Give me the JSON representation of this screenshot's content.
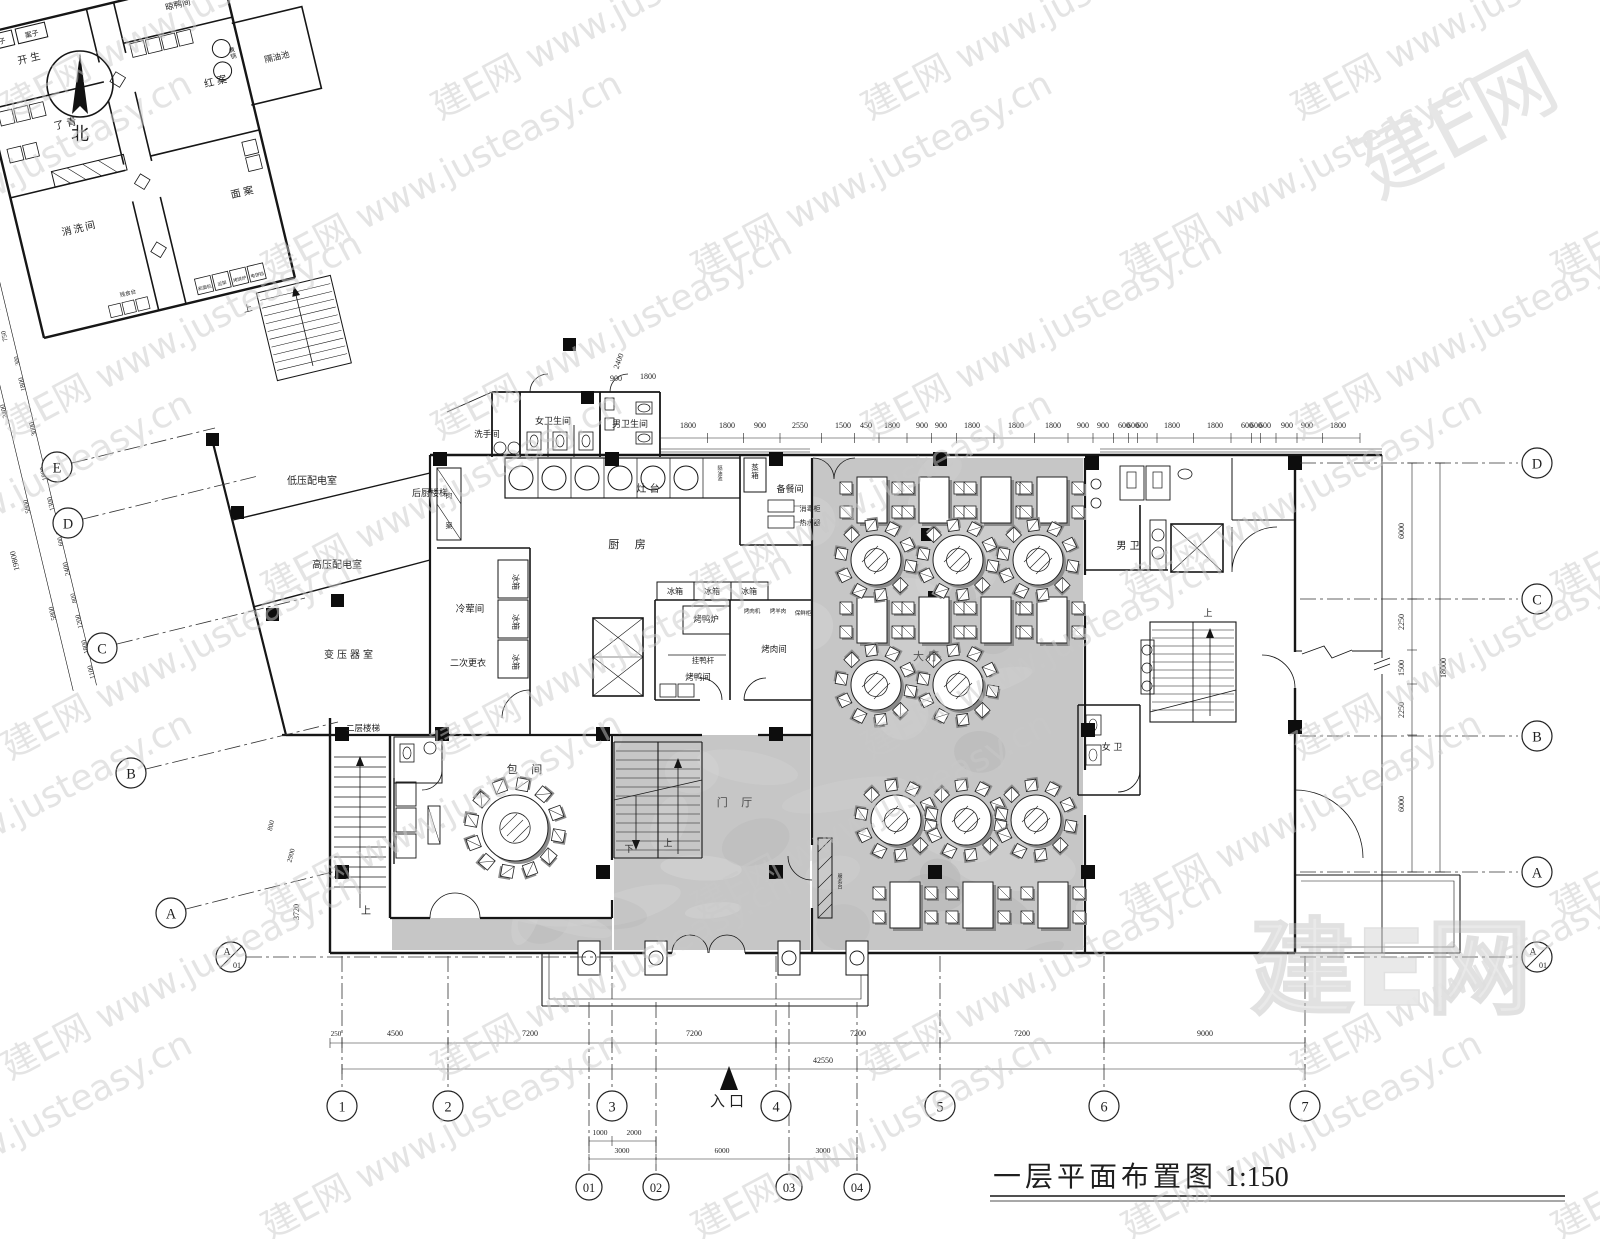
{
  "meta": {
    "title": "一层平面布置图",
    "scale_label": "1:150",
    "north_label": "北",
    "entrance_label": "入口",
    "up_label": "上",
    "down_label": "下"
  },
  "watermark": {
    "tile": "建E网 www.justeasy.cn",
    "big": "建E网",
    "site": "www.justeasy.cn"
  },
  "grid_bubbles": {
    "left": [
      {
        "l": "E",
        "x": 57,
        "y": 467
      },
      {
        "l": "D",
        "x": 68,
        "y": 523
      },
      {
        "l": "C",
        "x": 102,
        "y": 648
      },
      {
        "l": "B",
        "x": 131,
        "y": 773
      },
      {
        "l": "A",
        "x": 171,
        "y": 913
      },
      {
        "l": "A",
        "sub": "01",
        "x": 231,
        "y": 957
      }
    ],
    "right": [
      {
        "l": "D",
        "x": 1537,
        "y": 463
      },
      {
        "l": "C",
        "x": 1537,
        "y": 599
      },
      {
        "l": "B",
        "x": 1537,
        "y": 736
      },
      {
        "l": "A",
        "x": 1537,
        "y": 872
      },
      {
        "l": "A",
        "sub": "01",
        "x": 1537,
        "y": 957
      }
    ],
    "bottom": [
      {
        "l": "1",
        "x": 342,
        "y": 1106
      },
      {
        "l": "2",
        "x": 448,
        "y": 1106
      },
      {
        "l": "3",
        "x": 612,
        "y": 1106
      },
      {
        "l": "4",
        "x": 776,
        "y": 1106
      },
      {
        "l": "5",
        "x": 940,
        "y": 1106
      },
      {
        "l": "6",
        "x": 1104,
        "y": 1106
      },
      {
        "l": "7",
        "x": 1305,
        "y": 1106
      }
    ],
    "bottom_sub": [
      {
        "l": "01",
        "x": 589,
        "y": 1187
      },
      {
        "l": "02",
        "x": 656,
        "y": 1187
      },
      {
        "l": "03",
        "x": 789,
        "y": 1187
      },
      {
        "l": "04",
        "x": 857,
        "y": 1187
      }
    ]
  },
  "room_labels": [
    {
      "t": "低压配电室",
      "x": 312,
      "y": 484,
      "s": 10
    },
    {
      "t": "高压配电室",
      "x": 337,
      "y": 568,
      "s": 10
    },
    {
      "t": "变压器室",
      "x": 350,
      "y": 658,
      "s": 10,
      "ls": 3
    },
    {
      "t": "后厨楼梯",
      "x": 430,
      "y": 496,
      "s": 9
    },
    {
      "t": "洗手间",
      "x": 487,
      "y": 437,
      "s": 8.5
    },
    {
      "t": "女卫生间",
      "x": 553,
      "y": 424,
      "s": 9
    },
    {
      "t": "男卫生间",
      "x": 630,
      "y": 427,
      "s": 9
    },
    {
      "t": "灶 台",
      "x": 648,
      "y": 492,
      "s": 10
    },
    {
      "t": "厨 房",
      "x": 630,
      "y": 548,
      "s": 11,
      "ls": 6
    },
    {
      "t": "冷荤间",
      "x": 470,
      "y": 612,
      "s": 9.5
    },
    {
      "t": "二次更衣",
      "x": 468,
      "y": 666,
      "s": 9
    },
    {
      "t": "备餐间",
      "x": 790,
      "y": 492,
      "s": 9
    },
    {
      "t": "大厅",
      "x": 928,
      "y": 660,
      "s": 11,
      "ls": 4,
      "f": "#555555"
    },
    {
      "t": "男 卫",
      "x": 1128,
      "y": 549,
      "s": 10
    },
    {
      "t": "女 卫",
      "x": 1112,
      "y": 750,
      "s": 9
    },
    {
      "t": "门 厅",
      "x": 737,
      "y": 806,
      "s": 11,
      "ls": 5,
      "f": "#4a4a4a"
    },
    {
      "t": "包 间",
      "x": 527,
      "y": 773,
      "s": 11,
      "ls": 5
    },
    {
      "t": "二层楼梯",
      "x": 363,
      "y": 731,
      "s": 8.5
    },
    {
      "t": "烤鸭炉",
      "x": 706,
      "y": 622,
      "s": 8.5
    },
    {
      "t": "烤鸭间",
      "x": 698,
      "y": 680,
      "s": 8.5
    },
    {
      "t": "烤肉间",
      "x": 774,
      "y": 652,
      "s": 8.5
    },
    {
      "t": "挂鸭杆",
      "x": 703,
      "y": 663,
      "s": 7.5
    },
    {
      "t": "冰箱",
      "x": 513,
      "y": 582,
      "s": 8,
      "r": 90
    },
    {
      "t": "冰箱",
      "x": 513,
      "y": 622,
      "s": 8,
      "r": 90
    },
    {
      "t": "冰箱",
      "x": 513,
      "y": 662,
      "s": 8,
      "r": 90
    },
    {
      "t": "冰箱",
      "x": 675,
      "y": 594,
      "s": 8
    },
    {
      "t": "冰箱",
      "x": 712,
      "y": 594,
      "s": 8
    },
    {
      "t": "冰箱",
      "x": 749,
      "y": 594,
      "s": 8
    }
  ],
  "tiny_labels": [
    {
      "t": "蒸箱",
      "x": 755,
      "y": 470,
      "s": 7.5,
      "v": 1
    },
    {
      "t": "消毒柜",
      "x": 810,
      "y": 511,
      "s": 7
    },
    {
      "t": "热水器",
      "x": 810,
      "y": 525,
      "s": 7
    },
    {
      "t": "烤肉机",
      "x": 752,
      "y": 613,
      "s": 5.5
    },
    {
      "t": "烤羊肉",
      "x": 778,
      "y": 613,
      "s": 5.5
    },
    {
      "t": "保鲜柜",
      "x": 803,
      "y": 615,
      "s": 5.5
    },
    {
      "t": "服务台",
      "x": 840,
      "y": 878,
      "s": 5,
      "v": 1
    },
    {
      "t": "肉",
      "x": 449,
      "y": 498,
      "s": 7
    },
    {
      "t": "案",
      "x": 449,
      "y": 528,
      "s": 7
    },
    {
      "t": "隔油池",
      "x": 720,
      "y": 470,
      "s": 5,
      "v": 1
    }
  ],
  "stair_labels": [
    {
      "t": "上",
      "x": 366,
      "y": 914,
      "s": 10
    },
    {
      "t": "上",
      "x": 668,
      "y": 846,
      "s": 9
    },
    {
      "t": "下",
      "x": 629,
      "y": 852,
      "s": 9
    },
    {
      "t": "上",
      "x": 1208,
      "y": 616,
      "s": 9
    }
  ],
  "wing": {
    "labels": [
      {
        "t": "案子",
        "x": 25,
        "y": 14,
        "s": 7
      },
      {
        "t": "案子",
        "x": 59,
        "y": 14,
        "s": 7
      },
      {
        "t": "开生",
        "x": 52,
        "y": 38,
        "s": 10,
        "ls": 3
      },
      {
        "t": "晾鸭间",
        "x": 208,
        "y": 20,
        "s": 8.5
      },
      {
        "t": "红案",
        "x": 228,
        "y": 104,
        "s": 10,
        "ls": 3
      },
      {
        "t": "隔油池",
        "x": 292,
        "y": 94,
        "s": 8.5
      },
      {
        "t": "煮锅",
        "x": 250,
        "y": 76,
        "s": 6,
        "v": 1
      },
      {
        "t": "了青",
        "x": 72,
        "y": 110,
        "s": 10,
        "ls": 3
      },
      {
        "t": "面案",
        "x": 228,
        "y": 218,
        "s": 10,
        "ls": 3
      },
      {
        "t": "消洗间",
        "x": 60,
        "y": 215,
        "s": 10,
        "ls": 2
      },
      {
        "t": "残食台",
        "x": 92,
        "y": 288,
        "s": 5.5
      },
      {
        "t": "上",
        "x": 205,
        "y": 332,
        "s": 9
      },
      {
        "t": "和面机",
        "x": 168,
        "y": 300,
        "s": 4.5
      },
      {
        "t": "运架",
        "x": 186,
        "y": 300,
        "s": 4.5
      },
      {
        "t": "烤饼炉",
        "x": 204,
        "y": 300,
        "s": 4.5
      },
      {
        "t": "电饼铛",
        "x": 222,
        "y": 300,
        "s": 4.5
      }
    ],
    "dims": [
      {
        "t": "11720",
        "x": 139,
        "y": -60,
        "s": 9
      },
      {
        "t": "4820",
        "x": 268,
        "y": -60,
        "s": 9
      },
      {
        "t": "4820",
        "x": 52,
        "y": -34,
        "s": 9
      },
      {
        "t": "290",
        "x": 112,
        "y": -36,
        "s": 6.5
      },
      {
        "t": "1500",
        "x": 131,
        "y": -36,
        "s": 7
      },
      {
        "t": "290",
        "x": 150,
        "y": -36,
        "s": 6.5
      },
      {
        "t": "790",
        "x": -36,
        "y": 30,
        "s": 7,
        "r": -90
      },
      {
        "t": "1470",
        "x": -36,
        "y": 64,
        "s": 7,
        "r": -90
      },
      {
        "t": "750",
        "x": -36,
        "y": 97,
        "s": 7,
        "r": -90
      },
      {
        "t": "290",
        "x": -36,
        "y": 113,
        "s": 6,
        "r": -90
      },
      {
        "t": "790",
        "x": -36,
        "y": 131,
        "s": 7,
        "r": -90
      },
      {
        "t": "1470",
        "x": -36,
        "y": 165,
        "s": 7,
        "r": -90
      },
      {
        "t": "750",
        "x": -36,
        "y": 198,
        "s": 7,
        "r": -90
      },
      {
        "t": "290",
        "x": -36,
        "y": 214,
        "s": 6,
        "r": -90
      },
      {
        "t": "790",
        "x": -36,
        "y": 232,
        "s": 7,
        "r": -90
      },
      {
        "t": "1470",
        "x": -36,
        "y": 266,
        "s": 7,
        "r": -90
      },
      {
        "t": "750",
        "x": -36,
        "y": 299,
        "s": 7,
        "r": -90
      },
      {
        "t": "12910",
        "x": -60,
        "y": 160,
        "s": 8,
        "r": -90
      },
      {
        "t": "300",
        "x": -30,
        "y": 326,
        "s": 6,
        "r": -90
      },
      {
        "t": "1800",
        "x": -30,
        "y": 350,
        "s": 7,
        "r": -90
      },
      {
        "t": "3000",
        "x": -30,
        "y": 396,
        "s": 7,
        "r": -90
      },
      {
        "t": "1800",
        "x": -30,
        "y": 442,
        "s": 7,
        "r": -90
      },
      {
        "t": "1300",
        "x": -30,
        "y": 473,
        "s": 7,
        "r": -90
      },
      {
        "t": "600",
        "x": -30,
        "y": 500,
        "s": 6,
        "r": -90
      },
      {
        "t": "600",
        "x": -30,
        "y": 512,
        "s": 6,
        "r": -90
      },
      {
        "t": "2400",
        "x": -30,
        "y": 540,
        "s": 7,
        "r": -90
      },
      {
        "t": "800",
        "x": -30,
        "y": 570,
        "s": 6.5,
        "r": -90
      },
      {
        "t": "1200",
        "x": -30,
        "y": 594,
        "s": 7,
        "r": -90
      },
      {
        "t": "1800",
        "x": -30,
        "y": 620,
        "s": 7,
        "r": -90
      },
      {
        "t": "1100",
        "x": -30,
        "y": 646,
        "s": 7,
        "r": -90
      },
      {
        "t": "2400",
        "x": -54,
        "y": 372,
        "s": 7,
        "r": -90
      },
      {
        "t": "5800",
        "x": -54,
        "y": 470,
        "s": 7,
        "r": -90
      },
      {
        "t": "5800",
        "x": -54,
        "y": 580,
        "s": 7,
        "r": -90
      },
      {
        "t": "19800",
        "x": -78,
        "y": 520,
        "s": 8,
        "r": -90
      }
    ]
  },
  "dims": {
    "top_y": 428,
    "top": [
      {
        "t": "1800",
        "x": 688
      },
      {
        "t": "1800",
        "x": 727
      },
      {
        "t": "900",
        "x": 760
      },
      {
        "t": "2550",
        "x": 800
      },
      {
        "t": "1500",
        "x": 843
      },
      {
        "t": "450",
        "x": 866
      },
      {
        "t": "1800",
        "x": 892
      },
      {
        "t": "900",
        "x": 922
      },
      {
        "t": "900",
        "x": 941
      },
      {
        "t": "1800",
        "x": 972
      },
      {
        "t": "1800",
        "x": 1016
      },
      {
        "t": "1800",
        "x": 1053
      },
      {
        "t": "900",
        "x": 1083
      },
      {
        "t": "900",
        "x": 1103
      },
      {
        "t": "600",
        "x": 1124
      },
      {
        "t": "600",
        "x": 1133
      },
      {
        "t": "600",
        "x": 1142
      },
      {
        "t": "1800",
        "x": 1172
      },
      {
        "t": "1800",
        "x": 1215
      },
      {
        "t": "600",
        "x": 1247
      },
      {
        "t": "600",
        "x": 1256
      },
      {
        "t": "600",
        "x": 1265
      },
      {
        "t": "900",
        "x": 1287
      },
      {
        "t": "900",
        "x": 1307
      },
      {
        "t": "1800",
        "x": 1338
      }
    ],
    "aux": [
      {
        "t": "900",
        "x": 616,
        "y": 381,
        "s": 8
      },
      {
        "t": "1800",
        "x": 648,
        "y": 379,
        "s": 8
      },
      {
        "t": "2400",
        "x": 621,
        "y": 362,
        "s": 8,
        "r": -70
      },
      {
        "t": "800",
        "x": 273,
        "y": 826,
        "s": 7,
        "r": -76
      },
      {
        "t": "2900",
        "x": 293,
        "y": 856,
        "s": 7,
        "r": -76
      },
      {
        "t": "3720",
        "x": 299,
        "y": 912,
        "s": 8,
        "r": -90
      }
    ],
    "right_x": 1404,
    "right": [
      {
        "t": "6000",
        "y": 531
      },
      {
        "t": "2250",
        "y": 622
      },
      {
        "t": "1500",
        "y": 668
      },
      {
        "t": "2250",
        "y": 710
      },
      {
        "t": "6000",
        "y": 804
      }
    ],
    "right_total": {
      "t": "18000",
      "x": 1446,
      "y": 668
    },
    "bottom_y": 1036,
    "bottom": [
      {
        "t": "250",
        "x": 336,
        "s": 7
      },
      {
        "t": "4500",
        "x": 395
      },
      {
        "t": "7200",
        "x": 530
      },
      {
        "t": "7200",
        "x": 694
      },
      {
        "t": "7200",
        "x": 858
      },
      {
        "t": "7200",
        "x": 1022
      },
      {
        "t": "9000",
        "x": 1205
      }
    ],
    "bottom_total": {
      "t": "42550",
      "x": 823,
      "y": 1063
    },
    "bottom_sub": [
      {
        "t": "1000",
        "x": 600,
        "y": 1135
      },
      {
        "t": "2000",
        "x": 634,
        "y": 1135
      },
      {
        "t": "3000",
        "x": 622,
        "y": 1153
      },
      {
        "t": "6000",
        "x": 722,
        "y": 1153
      },
      {
        "t": "3000",
        "x": 823,
        "y": 1153
      }
    ]
  },
  "furniture": {
    "round10": [
      [
        876,
        560
      ],
      [
        958,
        560
      ],
      [
        1038,
        560
      ],
      [
        876,
        685
      ],
      [
        958,
        685
      ],
      [
        896,
        820
      ],
      [
        966,
        820
      ],
      [
        1036,
        820
      ]
    ],
    "rect4": [
      [
        872,
        500
      ],
      [
        934,
        500
      ],
      [
        996,
        500
      ],
      [
        1052,
        500
      ],
      [
        872,
        620
      ],
      [
        934,
        620
      ],
      [
        996,
        620
      ],
      [
        1052,
        620
      ],
      [
        905,
        905
      ],
      [
        978,
        905
      ],
      [
        1053,
        905
      ]
    ],
    "round12": [
      [
        515,
        828
      ]
    ]
  }
}
